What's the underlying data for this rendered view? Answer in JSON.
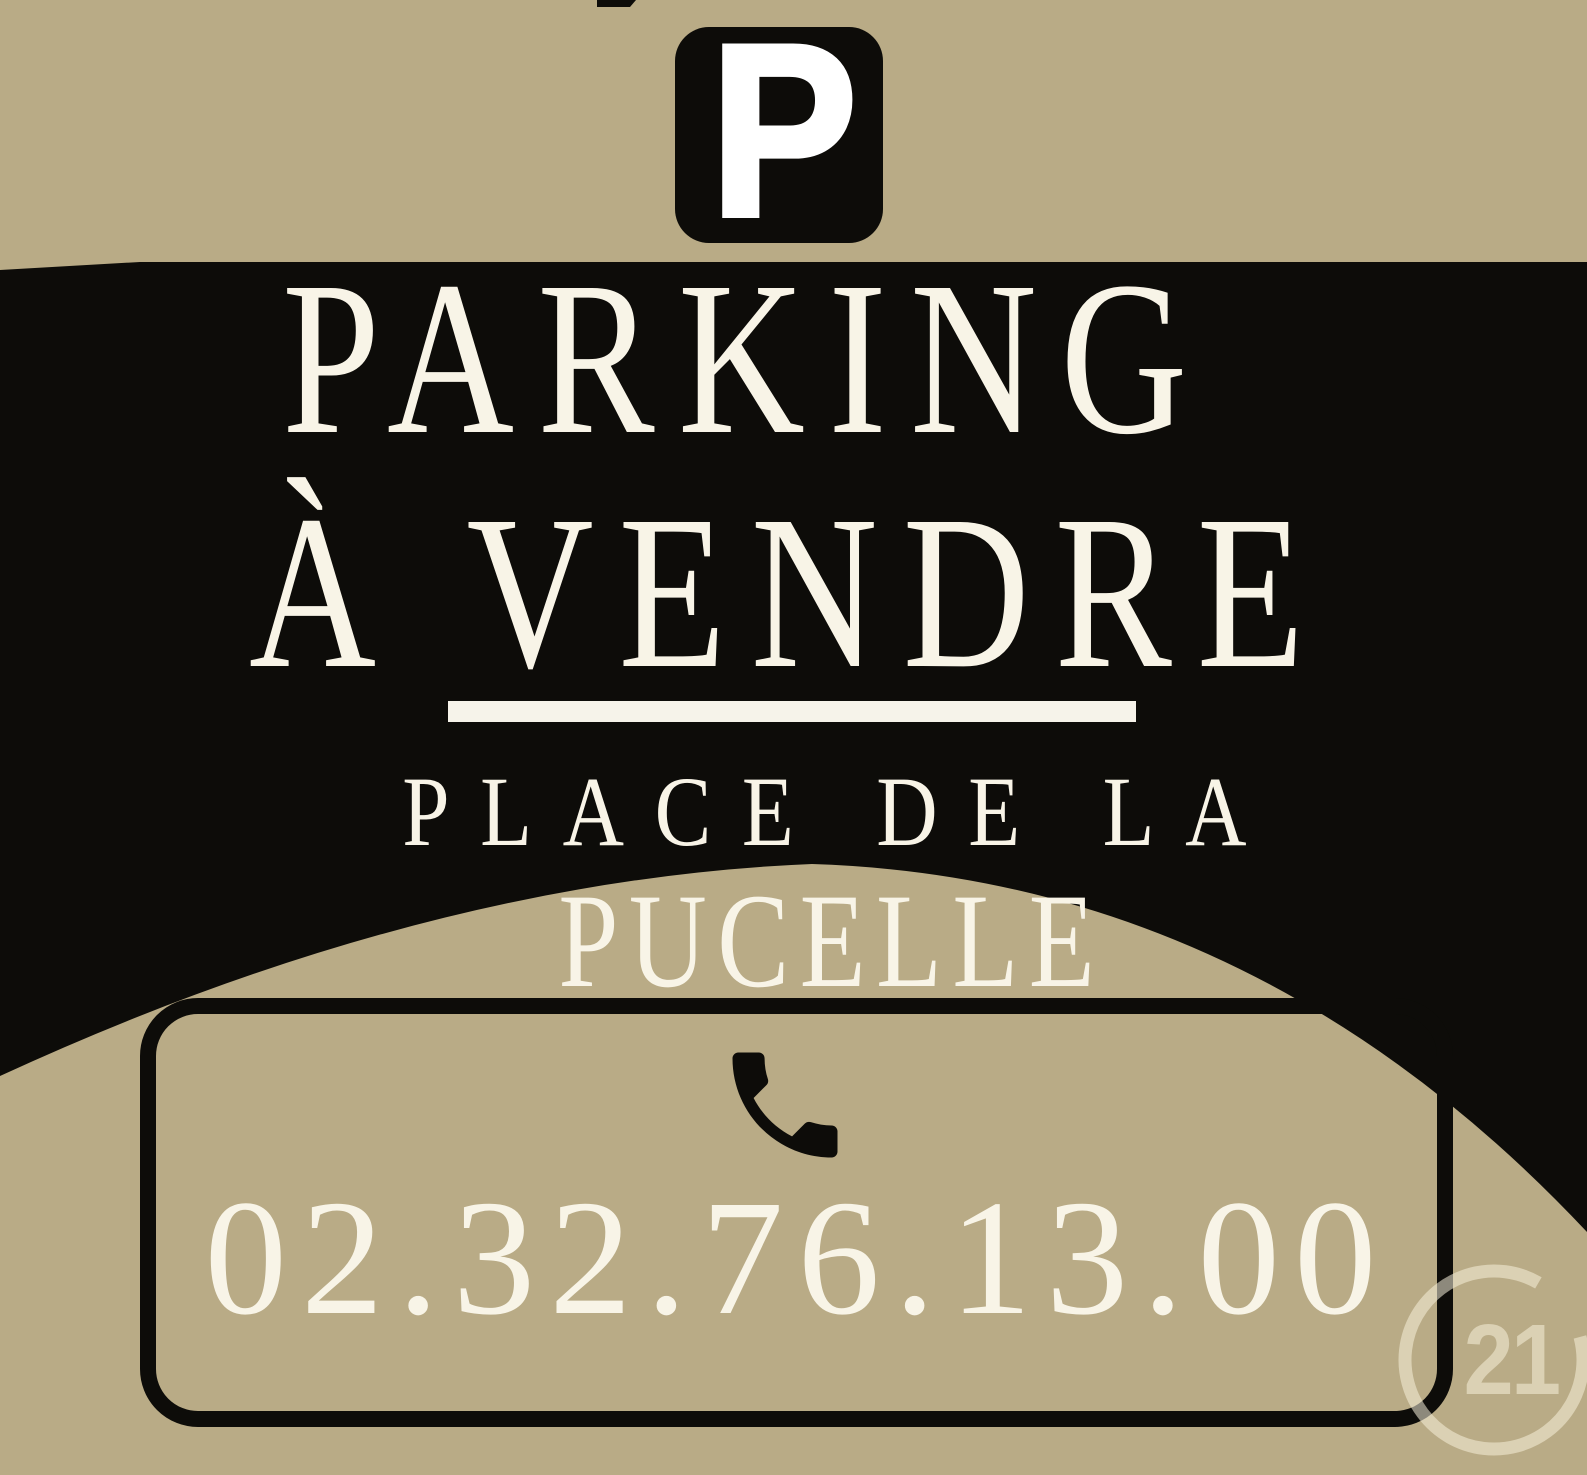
{
  "poster": {
    "colors": {
      "background_tan": "#b9ab86",
      "banner_black": "#0d0c09",
      "text_cream": "#f8f4e7",
      "underline_white": "#f6f3ea",
      "watermark_cream": "rgba(247,240,219,0.55)"
    },
    "parking_sign": {
      "letter": "P"
    },
    "title_line1": "PARKING",
    "title_line2": "À VENDRE",
    "location_line1": "PLACE DE LA",
    "location_line2": "PUCELLE",
    "contact": {
      "phone_number": "02.32.76.13.00"
    },
    "brand": {
      "logo_number": "21"
    },
    "icons": {
      "phone": "phone-handset-icon",
      "parking": "parking-p-icon",
      "brand_ring": "c-ring-icon"
    }
  }
}
